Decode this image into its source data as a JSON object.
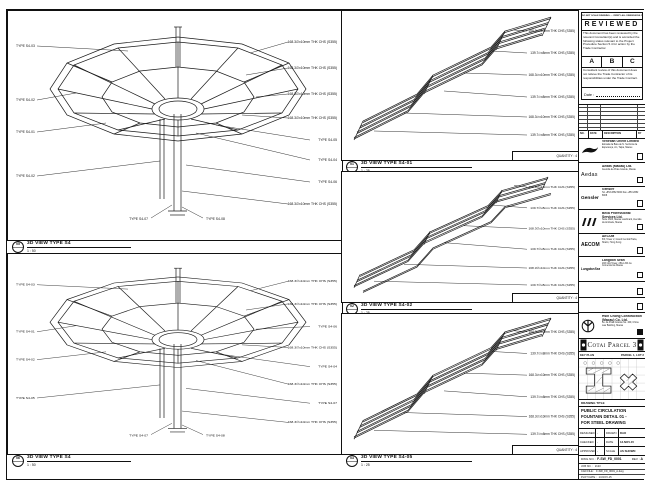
{
  "panels": {
    "left": [
      {
        "callout": "05",
        "title": "3D VIEW TYPE S4",
        "scale": "1 : 50",
        "left_labels": [
          "TYPE S4-03",
          "TYPE S4-02",
          "TYPE S4-01",
          "TYPE S4-02"
        ],
        "right_labels": [
          "168.3∅x10mm THK CHS (S355)",
          "168.3∅x10mm THK CHS (S355)",
          "168.3∅x10mm THK CHS (S355)",
          "168.3∅x10mm THK CHS (S355)",
          "TYPE S4-05",
          "TYPE S4-04",
          "TYPE S4-06",
          "168.3∅x10mm THK CHS (S355)"
        ],
        "bottom_labels": [
          "TYPE S4-08",
          "TYPE S4-07"
        ]
      },
      {
        "callout": "06",
        "title": "3D VIEW TYPE S4",
        "scale": "1 : 50",
        "left_labels": [
          "TYPE S4-03",
          "TYPE S4-01",
          "TYPE S4-02",
          "TYPE S4-05"
        ],
        "right_labels": [
          "168.3∅x10mm THK CHS (S355)",
          "168.3∅x10mm THK CHS (S355)",
          "TYPE S4-06",
          "168.3∅x10mm THK CHS (S355)",
          "TYPE S4-04",
          "168.3∅x10mm THK CHS (S355)",
          "TYPE S4-07",
          "168.3∅x10mm THK CHS (S355)"
        ],
        "bottom_labels": [
          "TYPE S4-08",
          "TYPE S4-07"
        ]
      }
    ],
    "mid": [
      {
        "callout": "01",
        "title": "3D VIEW TYPE S4-01",
        "scale": "1 : 25",
        "quantity": "QUANTITY : 4",
        "labels": [
          "168.3∅x10mm THK CHS (S355)",
          "139.7∅x8mm THK CHS (S355)",
          "168.3∅x10mm THK CHS (S355)",
          "139.7∅x8mm THK CHS (S355)",
          "168.3∅x10mm THK CHS (S355)",
          "139.7∅x8mm THK CHS (S355)"
        ]
      },
      {
        "callout": "02",
        "title": "3D VIEW TYPE S4-02",
        "scale": "1 : 25",
        "quantity": "QUANTITY : 4",
        "labels": [
          "168.3∅x10mm THK CHS (S355)",
          "139.7∅x8mm THK CHS (S355)",
          "168.3∅x10mm THK CHS (S355)",
          "139.7∅x8mm THK CHS (S355)",
          "168.3∅x10mm THK CHS (S355)",
          "139.7∅x8mm THK CHS (S355)"
        ]
      },
      {
        "callout": "03",
        "title": "3D VIEW TYPE S4-05",
        "scale": "1 : 25",
        "quantity": "QUANTITY : 4",
        "labels": [
          "168.3∅x10mm THK CHS (S355)",
          "139.7∅x8mm THK CHS (S355)",
          "168.3∅x10mm THK CHS (S355)",
          "139.7∅x8mm THK CHS (S355)",
          "168.3∅x10mm THK CHS (S355)",
          "139.7∅x8mm THK CHS (S355)"
        ]
      }
    ]
  },
  "titleblock": {
    "stamp": {
      "header_note": "DO NOT SCALE DRAWING — VERIFY ALL DIMENSIONS ON SITE",
      "title": "REVIEWED",
      "body": "This document has been reviewed by the relevant Consultant(s) and is accorded the following status relevant to the Project Procedure Section 5.4 for action by the Trade Contractor.",
      "grades": [
        "A",
        "B",
        "C"
      ],
      "note2": "Consultant review of this document does not relieve the Trade Contractor of its responsibilities under the Trade Contract.",
      "date_label": "Date :"
    },
    "rev_table": {
      "headers": [
        "NO.",
        "DATE",
        "DESCRIPTION",
        "BY"
      ]
    },
    "companies": [
      {
        "name": "Venetian Orient Limited",
        "details": "Estrada da Baía de N. Senhora da Esperança, s/n, Taipa, Macau"
      },
      {
        "name": "Aedas (Macau) Ltd.",
        "details": "Avenida da Praia Grande, Macau"
      },
      {
        "name": "Gensler",
        "details": "Tel +853 2882 8000  Fax +853 2882 8008"
      },
      {
        "name": "Beca Professional Services Ltd.",
        "details": "Suite 1606, Macau Landmark, Avenida da Amizade, Macau"
      },
      {
        "name": "AECOM",
        "details": "8/F, Tower 2, Grand Central Plaza, Shatin, Hong Kong"
      },
      {
        "name": "Langdon Seah",
        "details": "20/F AIA Tower, 251A-301 Av. Comercial de Macau"
      },
      {
        "name": "",
        "details": ""
      },
      {
        "name": "",
        "details": ""
      },
      {
        "name": "Hsin Chong Construction (Macau) Co. Ltd.",
        "details": "Av. da Praia Grande No. 409, China Law Building, Macau"
      }
    ],
    "logos": {
      "aedas": "Aedas",
      "gensler": "Gensler",
      "aecom": "AECOM",
      "langdon": "LangdonSeah"
    },
    "project_banner": "Cotai Parcel 3",
    "key_plan": {
      "label": "KEY PLAN",
      "plot_label": "PARCEL 1, LOT 2"
    },
    "drawing_title": {
      "header": "DRAWING TITLE",
      "line1": "PUBLIC CIRCULATION",
      "line2": "FOUNTAIN DETAIL 01 -",
      "line3": "FOR STEEL DRAWING"
    },
    "info": {
      "rows": [
        {
          "k1": "DESIGNED",
          "v1": "-",
          "k2": "DRAWN",
          "v2": "DAO"
        },
        {
          "k1": "CHECKED",
          "v1": "-",
          "k2": "DATE",
          "v2": "13-NOV-15"
        },
        {
          "k1": "APPROVED",
          "v1": "-",
          "k2": "SCALE",
          "v2": "AS SHOWN"
        }
      ],
      "dwg_label": "DWG NO. :",
      "dwg_no": "F-SW_FD_0001",
      "rev_label": "REV :",
      "rev": "A",
      "job_label": "JOB NO. :",
      "job_no": "2123",
      "cad_label": "CAD FILE :",
      "cad_no": "F-SW_FD_0001_A.dwg",
      "plot_label": "PLOT DATE :",
      "plot": "13-NOV-15"
    }
  }
}
